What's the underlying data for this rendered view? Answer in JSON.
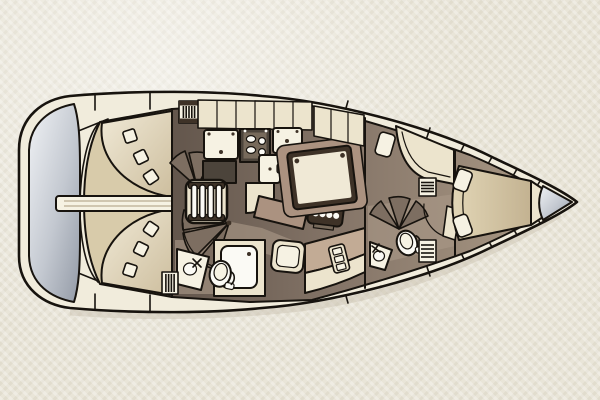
{
  "document": {
    "kind": "yacht-interior-floor-plan",
    "orientation": "bow-right-stern-left",
    "visible_text": "none"
  },
  "palette": {
    "paper": "#e9e5d8",
    "line": "#17130e",
    "deck": "#f1ecdc",
    "cream": "#ece4cd",
    "bright": "#f6f2e3",
    "tan": "#d8cbaa",
    "tanDeep": "#c2b191",
    "floorD": "#675a50",
    "floorM": "#8a7b6f",
    "floorL": "#a89786",
    "rose": "#ab9280",
    "roseL": "#c2ab95",
    "tableTop": "#f0e9d6",
    "tableEdge": "#3e3227",
    "appD": "#4c443b",
    "appM": "#776a5b",
    "metalL": "#eef0f3",
    "metalD": "#99a0ab",
    "white": "#fbfaf5",
    "fan": "#7d6e61"
  },
  "rooms": [
    {
      "name": "swim-platform",
      "label": "Stern swim platform"
    },
    {
      "name": "cockpit",
      "label": "Cockpit with twin curved benches and centreline table"
    },
    {
      "name": "galley",
      "label": "Galley with double sink, stove, fridge and lockers"
    },
    {
      "name": "nav-station",
      "label": "Chart table with instrument panel and seat"
    },
    {
      "name": "saloon",
      "label": "Saloon with folding table and settee"
    },
    {
      "name": "aft-head",
      "label": "Aft head with toilet, corner sink and shower"
    },
    {
      "name": "forward-head",
      "label": "Forward head with toilet and corner sink"
    },
    {
      "name": "forward-cabin",
      "label": "Forward V-berth cabin with dresser and stools"
    },
    {
      "name": "anchor-locker",
      "label": "Bow anchor locker"
    }
  ],
  "fixtures": {
    "ladder_rungs": 4,
    "stove_burners": [
      {
        "cx": 251,
        "cy": 139,
        "rx": 4.6,
        "ry": 3.4
      },
      {
        "cx": 251,
        "cy": 150,
        "rx": 4.6,
        "ry": 3.4
      },
      {
        "cx": 262,
        "cy": 141,
        "rx": 3.4,
        "ry": 3.4
      },
      {
        "cx": 262,
        "cy": 152,
        "rx": 3.4,
        "ry": 3.4
      }
    ],
    "instrument_knobs": 4,
    "rack_slots": 3
  }
}
